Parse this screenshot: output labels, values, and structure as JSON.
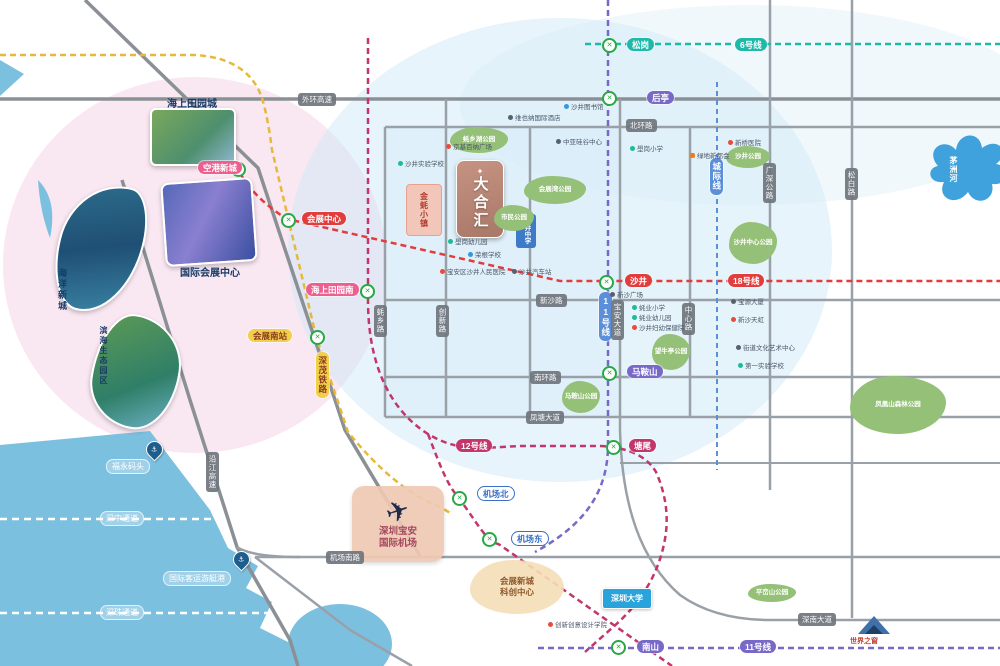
{
  "colors": {
    "line6": "#1fb9a9",
    "line11": "#7868c8",
    "line12": "#c2366b",
    "line18": "#e23d3d",
    "rail_yellow": "#e5b93c",
    "intercity_blue": "#5b8fd9",
    "sea": "#7cc0e0",
    "road_gray": "#979da6",
    "park_green": "#94c077",
    "pink_wash": "#f6d9ea",
    "blue_wash": "#cfe9f7"
  },
  "lines": [
    {
      "name": "6号线",
      "color": "#1fb9a9"
    },
    {
      "name": "11号线",
      "color": "#7868c8"
    },
    {
      "name": "12号线",
      "color": "#c2366b"
    },
    {
      "name": "18号线",
      "color": "#e23d3d"
    },
    {
      "name": "深茂铁路",
      "color": "#e5b93c"
    },
    {
      "name": "城际线",
      "color": "#5b8fd9"
    }
  ],
  "stations": [
    {
      "t": "空港新城",
      "x": 198,
      "y": 161,
      "c": "pink"
    },
    {
      "t": "会展中心",
      "x": 302,
      "y": 212,
      "c": "red"
    },
    {
      "t": "海上田园南",
      "x": 306,
      "y": 283,
      "c": "pink"
    },
    {
      "t": "会展南站",
      "x": 248,
      "y": 329,
      "c": "yellow"
    },
    {
      "t": "深茂铁路",
      "x": 316,
      "y": 352,
      "c": "yellow v"
    },
    {
      "t": "松岗",
      "x": 627,
      "y": 38,
      "c": "teal"
    },
    {
      "t": "6号线",
      "x": 735,
      "y": 38,
      "c": "teal"
    },
    {
      "t": "后亭",
      "x": 647,
      "y": 91,
      "c": "purple"
    },
    {
      "t": "沙井",
      "x": 625,
      "y": 274,
      "c": "red"
    },
    {
      "t": "18号线",
      "x": 728,
      "y": 274,
      "c": "red"
    },
    {
      "t": "11号线",
      "x": 599,
      "y": 292,
      "c": "lineblue v"
    },
    {
      "t": "城际线",
      "x": 710,
      "y": 158,
      "c": "lineblue v"
    },
    {
      "t": "马鞍山",
      "x": 627,
      "y": 365,
      "c": "purple"
    },
    {
      "t": "塘尾",
      "x": 629,
      "y": 439,
      "c": "crimson"
    },
    {
      "t": "12号线",
      "x": 456,
      "y": 439,
      "c": "crimson"
    },
    {
      "t": "机场北",
      "x": 477,
      "y": 486,
      "c": "airport-pill"
    },
    {
      "t": "机场东",
      "x": 511,
      "y": 531,
      "c": "airport-pill"
    },
    {
      "t": "南山",
      "x": 637,
      "y": 640,
      "c": "purple"
    },
    {
      "t": "11号线",
      "x": 740,
      "y": 640,
      "c": "purple"
    }
  ],
  "station_icons": [
    {
      "x": 231,
      "y": 162
    },
    {
      "x": 281,
      "y": 213
    },
    {
      "x": 360,
      "y": 284
    },
    {
      "x": 310,
      "y": 330
    },
    {
      "x": 602,
      "y": 38
    },
    {
      "x": 602,
      "y": 91
    },
    {
      "x": 599,
      "y": 275
    },
    {
      "x": 602,
      "y": 366
    },
    {
      "x": 606,
      "y": 440
    },
    {
      "x": 452,
      "y": 491
    },
    {
      "x": 482,
      "y": 532
    },
    {
      "x": 611,
      "y": 640
    }
  ],
  "roads": [
    {
      "t": "外环高速",
      "x": 298,
      "y": 93
    },
    {
      "t": "北环路",
      "x": 626,
      "y": 119
    },
    {
      "t": "新沙路",
      "x": 536,
      "y": 294
    },
    {
      "t": "南环路",
      "x": 530,
      "y": 371
    },
    {
      "t": "凤塘大道",
      "x": 526,
      "y": 411
    },
    {
      "t": "机场南路",
      "x": 326,
      "y": 551
    },
    {
      "t": "深南大道",
      "x": 798,
      "y": 613
    },
    {
      "t": "沿江高速",
      "x": 206,
      "y": 452,
      "c": "v"
    },
    {
      "t": "蚝乡路",
      "x": 374,
      "y": 305,
      "c": "v"
    },
    {
      "t": "创新路",
      "x": 436,
      "y": 305,
      "c": "v"
    },
    {
      "t": "宝安大道",
      "x": 611,
      "y": 300,
      "c": "v"
    },
    {
      "t": "中心路",
      "x": 682,
      "y": 303,
      "c": "v"
    },
    {
      "t": "广深公路",
      "x": 763,
      "y": 163,
      "c": "v"
    },
    {
      "t": "松白路",
      "x": 845,
      "y": 168,
      "c": "v"
    }
  ],
  "water_labels": [
    {
      "t": "福永码头",
      "x": 106,
      "y": 459
    },
    {
      "t": "深中通道",
      "x": 100,
      "y": 511
    },
    {
      "t": "国际客运游艇港",
      "x": 163,
      "y": 571
    },
    {
      "t": "深珠通道",
      "x": 100,
      "y": 605
    }
  ],
  "pins": [
    {
      "t": "⚓",
      "x": 146,
      "y": 441
    },
    {
      "t": "⚓",
      "x": 233,
      "y": 551
    }
  ],
  "parks": [
    {
      "t": "蚝乡湖公园",
      "x": 450,
      "y": 127,
      "w": 58,
      "h": 26
    },
    {
      "t": "会展湾公园",
      "x": 524,
      "y": 176,
      "w": 62,
      "h": 28
    },
    {
      "t": "市民公园",
      "x": 494,
      "y": 205,
      "w": 40,
      "h": 26
    },
    {
      "t": "沙井公园",
      "x": 726,
      "y": 146,
      "w": 44,
      "h": 22
    },
    {
      "t": "沙井中心公园",
      "x": 729,
      "y": 222,
      "w": 48,
      "h": 42
    },
    {
      "t": "望牛亭公园",
      "x": 652,
      "y": 334,
      "w": 38,
      "h": 36
    },
    {
      "t": "马鞍山公园",
      "x": 562,
      "y": 381,
      "w": 38,
      "h": 32
    },
    {
      "t": "凤凰山森林公园",
      "x": 850,
      "y": 376,
      "w": 96,
      "h": 58
    },
    {
      "t": "平峦山公园",
      "x": 748,
      "y": 584,
      "w": 48,
      "h": 18
    }
  ],
  "pois": [
    {
      "t": "京基百纳广场",
      "x": 446,
      "y": 141,
      "d": "red"
    },
    {
      "t": "沙井实验学校",
      "x": 398,
      "y": 158,
      "d": "teal"
    },
    {
      "t": "壆岗幼儿园",
      "x": 448,
      "y": 236,
      "d": "teal"
    },
    {
      "t": "荣根学校",
      "x": 468,
      "y": 249,
      "d": "blue"
    },
    {
      "t": "宝安区沙井人民医院",
      "x": 440,
      "y": 266,
      "d": "red"
    },
    {
      "t": "沙井汽车站",
      "x": 512,
      "y": 266,
      "d": "dark"
    },
    {
      "t": "沙井图书馆",
      "x": 564,
      "y": 101,
      "d": "blue"
    },
    {
      "t": "维也纳国际酒店",
      "x": 508,
      "y": 112,
      "d": "dark"
    },
    {
      "t": "中亚硅谷中心",
      "x": 556,
      "y": 136,
      "d": "dark"
    },
    {
      "t": "壆岗小学",
      "x": 630,
      "y": 143,
      "d": "teal"
    },
    {
      "t": "新桥医院",
      "x": 728,
      "y": 137,
      "d": "red"
    },
    {
      "t": "绿地新都会",
      "x": 690,
      "y": 150,
      "d": "orange"
    },
    {
      "t": "新沙广场",
      "x": 610,
      "y": 289,
      "d": "dark"
    },
    {
      "t": "蚝业小学",
      "x": 632,
      "y": 302,
      "d": "teal"
    },
    {
      "t": "蚝业幼儿园",
      "x": 632,
      "y": 312,
      "d": "teal"
    },
    {
      "t": "沙井妇幼保健院",
      "x": 632,
      "y": 322,
      "d": "red"
    },
    {
      "t": "宝源大厦",
      "x": 731,
      "y": 296,
      "d": "dark"
    },
    {
      "t": "新沙天虹",
      "x": 731,
      "y": 314,
      "d": "red"
    },
    {
      "t": "街道文化艺术中心",
      "x": 736,
      "y": 342,
      "d": "dark"
    },
    {
      "t": "第一实验学校",
      "x": 738,
      "y": 360,
      "d": "teal"
    },
    {
      "t": "创新创意设计学院",
      "x": 548,
      "y": 619,
      "d": "red"
    }
  ],
  "photos": {
    "tianyuan": "海上田园城",
    "haiyang": "海洋新城",
    "exhibition": "国际会展中心",
    "binhai": "滨海生态园区"
  },
  "landmarks": {
    "logo_spark": "✦",
    "logo_text": "大合汇",
    "school_badge": "沙井中学",
    "oyster_town": "金蚝小镇",
    "airport_line1": "深圳宝安",
    "airport_line2": "国际机场",
    "airport_plane": "✈",
    "expo_line1": "会展新城",
    "expo_line2": "科创中心",
    "university": "深圳大学",
    "world_window": "世界之窗",
    "river": "茅洲河"
  }
}
